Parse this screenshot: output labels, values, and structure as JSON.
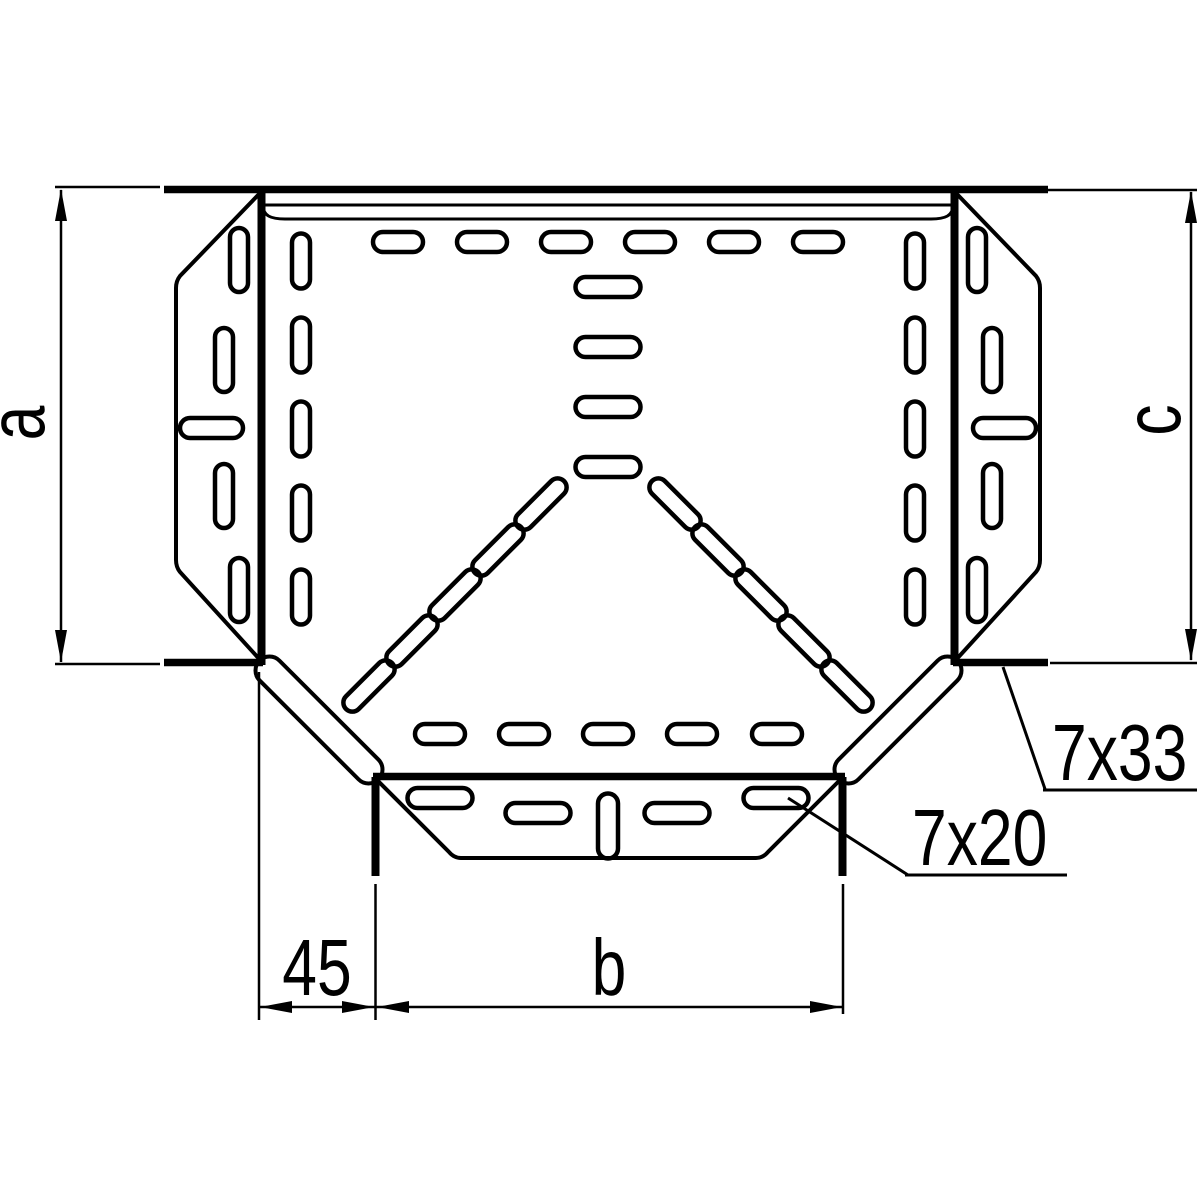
{
  "drawing": {
    "description": "Technical line drawing of a perforated cable-tray tee piece, top view, with dimension annotations",
    "colors": {
      "line": "#000000",
      "background": "#ffffff"
    },
    "labels": {
      "dim_a": "a",
      "dim_c": "c",
      "dim_45": "45",
      "dim_b": "b",
      "slot_size_side": "7x33",
      "slot_size_branch": "7x20"
    }
  }
}
